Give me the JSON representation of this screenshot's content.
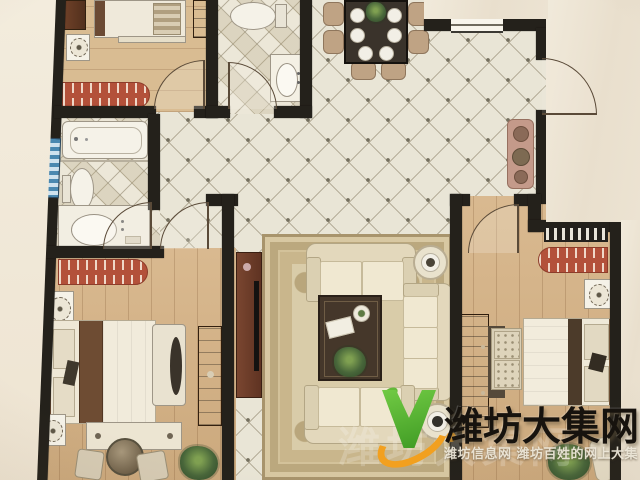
{
  "watermark": {
    "main_text": "潍坊大集网",
    "sub_text": "潍坊信息网 潍坊百姓的网上大集",
    "ghost_text": "潍坊大集网",
    "logo": {
      "v_color": "#4fae2c",
      "swoosh_color": "#f2a01f"
    }
  },
  "plan": {
    "type": "residential-floor-plan-photo",
    "rooms": [
      {
        "id": "bedroom-upper-left",
        "furniture": [
          "bed",
          "bedside-cabinet",
          "nightstand-with-lamp",
          "wardrobe",
          "striped-bench"
        ]
      },
      {
        "id": "bathroom-left",
        "furniture": [
          "bathtub",
          "toilet",
          "washbasin-counter"
        ],
        "window": "frosted-blue-strip"
      },
      {
        "id": "bathroom-top-center",
        "furniture": [
          "toilet",
          "washbasin"
        ]
      },
      {
        "id": "dining-area",
        "furniture": [
          "dining-table",
          "six-place-settings",
          "centerpiece-plant",
          "six-chairs"
        ]
      },
      {
        "id": "entry",
        "furniture": [
          "console-table-with-pots",
          "entrance-door"
        ]
      },
      {
        "id": "living-room",
        "furniture": [
          "ornate-rug",
          "loveseat-top",
          "sofa-right",
          "loveseat-bottom",
          "coffee-table",
          "center-plant",
          "tv-cabinet",
          "round-side-tables"
        ]
      },
      {
        "id": "bedroom-lower-left",
        "furniture": [
          "double-bed",
          "striped-dresser",
          "nightstand",
          "nightstand",
          "armchair",
          "foot-bench",
          "round-table",
          "two-chairs",
          "plant",
          "tv-cabinet"
        ]
      },
      {
        "id": "bedroom-right",
        "furniture": [
          "double-bed",
          "striped-dresser",
          "radiator-window",
          "nightstand",
          "wardrobe",
          "tufted-foot-bench",
          "plant",
          "chair"
        ]
      }
    ],
    "colors": {
      "wall": "#24211b",
      "wood_floor": "#d5b285",
      "tile_floor": "#e9e5d6",
      "red_furniture": "#b3513a",
      "paper_background": "#ece3d2"
    }
  }
}
